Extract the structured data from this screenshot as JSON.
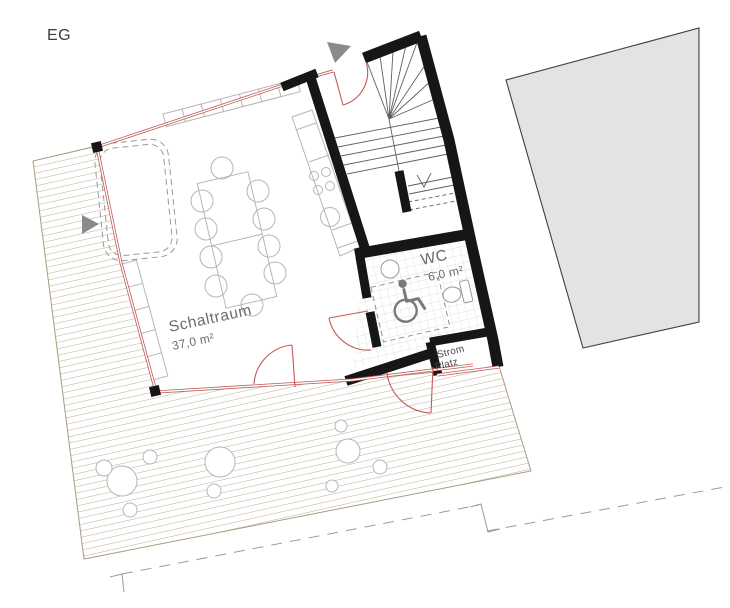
{
  "drawing": {
    "floor_label": "EG",
    "rooms": {
      "schaltraum": {
        "name": "Schaltraum",
        "area": "37,0 m²"
      },
      "wc": {
        "name": "WC",
        "area": "6,0 m²"
      },
      "strom_platz": {
        "line1": "Strom",
        "line2": "Platz"
      }
    },
    "colors": {
      "facade_red": "#c05a56",
      "wall_black": "#161616",
      "terrace_hatch": "#b1a489",
      "terrace_edge": "#a99b80",
      "neighbor_fill": "#e4e3e2",
      "neighbor_stroke": "#3f3f3f",
      "site_dash": "#9b9b9b",
      "marker_gray": "#8a8a8a",
      "label_gray": "#6b6b6b",
      "label_dark": "#4a4a4a",
      "tile_gray": "#d8d8d8",
      "fixture_gray": "#999999",
      "wheelchair_gray": "#7a7a7a"
    }
  }
}
